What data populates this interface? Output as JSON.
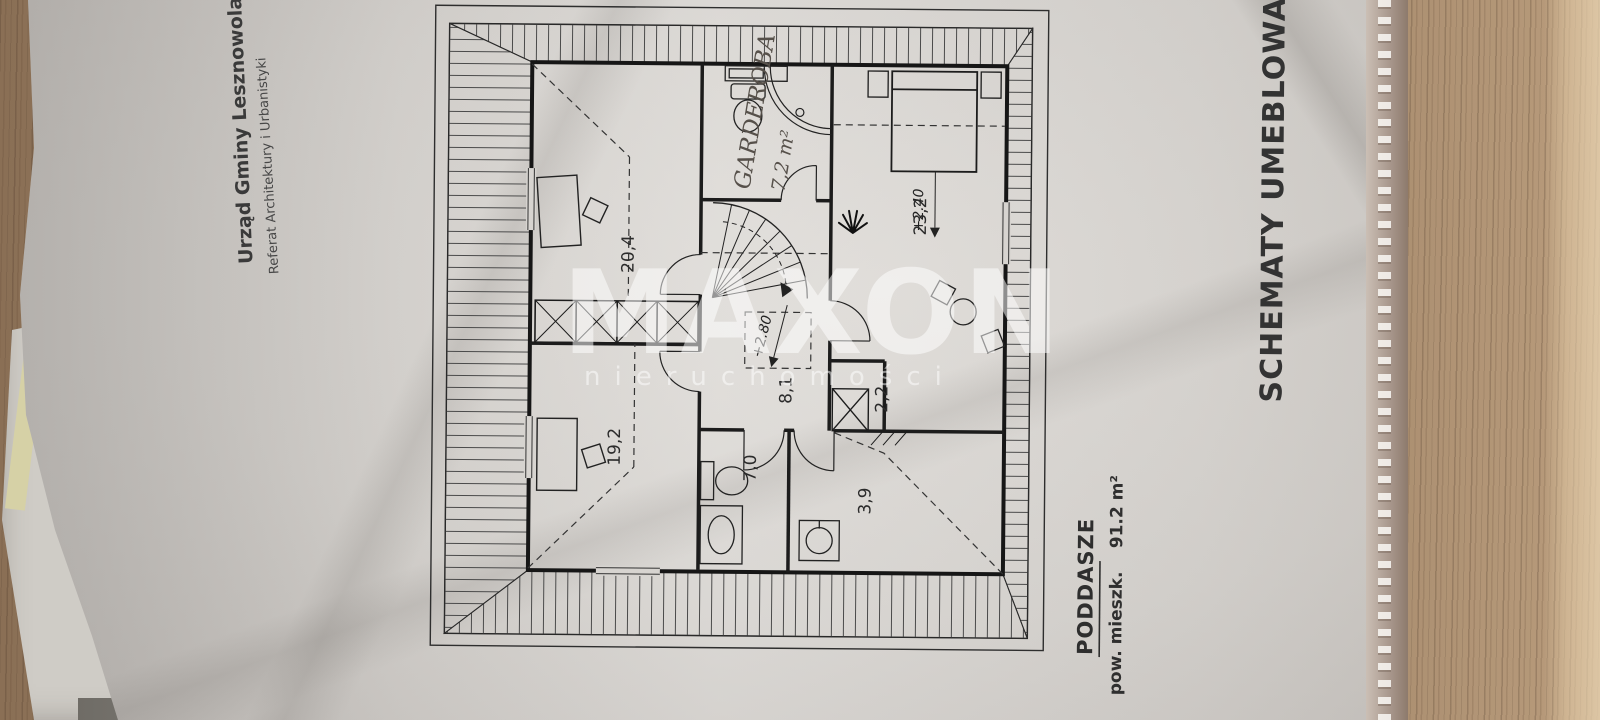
{
  "watermark": {
    "brand": "MAXON",
    "subtitle": "nieruchomości"
  },
  "stamp": {
    "line1": "Urząd Gminy Lesznowola",
    "line2": "Referat Architektury i Urbanistyki"
  },
  "side_title": "SCHEMATY UMEBLOWANIA W",
  "plan": {
    "floor_label": "PODDASZE",
    "area_caption": "pow. mieszk.",
    "area_value": "91.2 m²",
    "rooms": {
      "r204": "20,4",
      "r232": "23,2",
      "r192": "19,2",
      "r70": "7,0",
      "r81": "8,1",
      "r22": "2,2",
      "r39": "3,9"
    },
    "levels": {
      "upper": "+2.80",
      "lower": "+2.40"
    },
    "handwritten": {
      "line1": "GARDEROBA",
      "line2": "7,2 m²"
    }
  }
}
